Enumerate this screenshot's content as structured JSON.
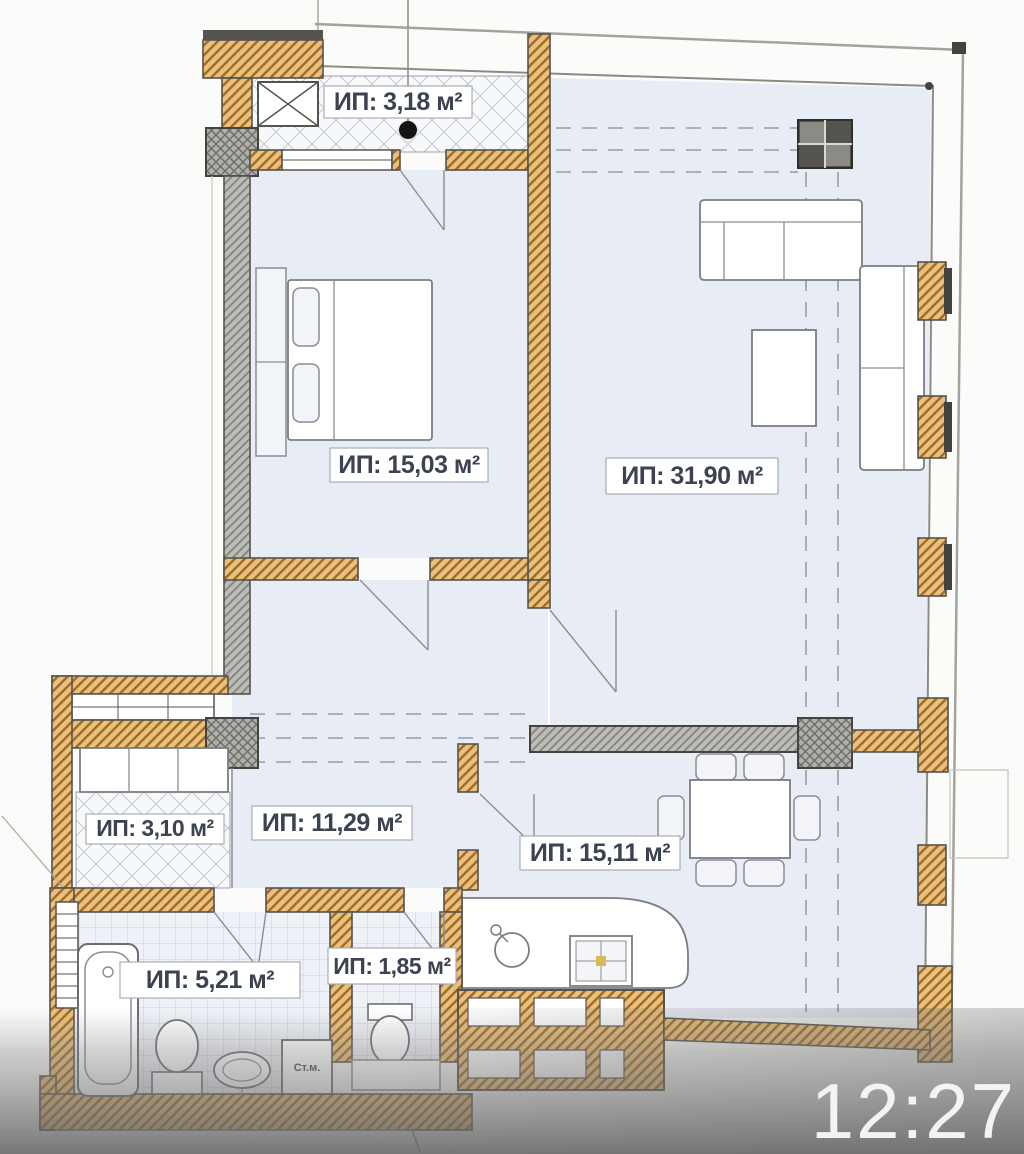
{
  "plan": {
    "rooms": [
      {
        "id": "loggia",
        "area_label": "ИП: 3,18 м²"
      },
      {
        "id": "bedroom",
        "area_label": "ИП: 15,03 м²"
      },
      {
        "id": "living-room",
        "area_label": "ИП: 31,90 м²"
      },
      {
        "id": "closet",
        "area_label": "ИП: 3,10 м²"
      },
      {
        "id": "hallway",
        "area_label": "ИП: 11,29 м²"
      },
      {
        "id": "kitchen-dining",
        "area_label": "ИП: 15,11 м²"
      },
      {
        "id": "bathroom",
        "area_label": "ИП: 5,21 м²"
      },
      {
        "id": "wc",
        "area_label": "ИП: 1,85 м²"
      }
    ],
    "appliances": {
      "washing_machine_label": "Ст.м."
    },
    "colors": {
      "brick_wall": "#e9c07c",
      "brick_hatch": "#a06a28",
      "concrete_wall": "#bcbcb8",
      "room_fill": "#e8ecf5",
      "outline": "#56534d"
    }
  },
  "overlay": {
    "clock": "12:27",
    "text_color": "#f3f3f3"
  }
}
